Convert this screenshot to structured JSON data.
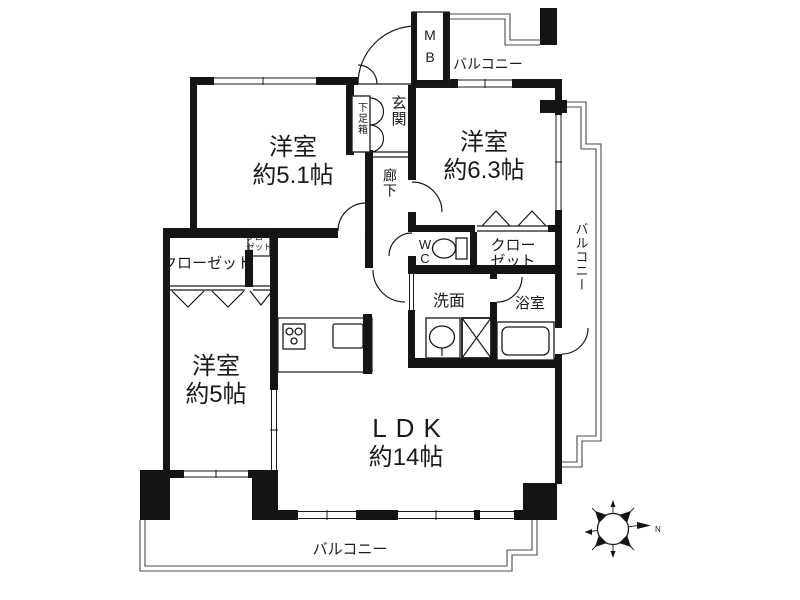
{
  "plan": {
    "rooms": {
      "bedroom_5_1": {
        "name": "洋室",
        "size": "約5.1帖"
      },
      "bedroom_6_3": {
        "name": "洋室",
        "size": "約6.3帖"
      },
      "bedroom_5": {
        "name": "洋室",
        "size": "約5帖"
      },
      "ldk": {
        "name": "LDK",
        "size": "約14帖"
      }
    },
    "labels": {
      "entrance": "玄関",
      "shoe_box": "下足箱",
      "corridor": "廊下",
      "wc_w": "W",
      "wc_c": "C",
      "washroom": "洗面",
      "bathroom": "浴室",
      "closet_left": "クローゼット",
      "closet_right_l1": "クロー",
      "closet_right_l2": "ゼット",
      "closet_small_l1": "クロー",
      "closet_small_l2": "ゼット",
      "mb_m": "M",
      "mb_b": "B",
      "balcony_top": "バルコニー",
      "balcony_right": "バルコニー",
      "balcony_bottom": "バルコニー",
      "compass_north": "N"
    },
    "colors": {
      "wall": "#141414",
      "line": "#1a1a1a",
      "background": "#ffffff"
    }
  }
}
